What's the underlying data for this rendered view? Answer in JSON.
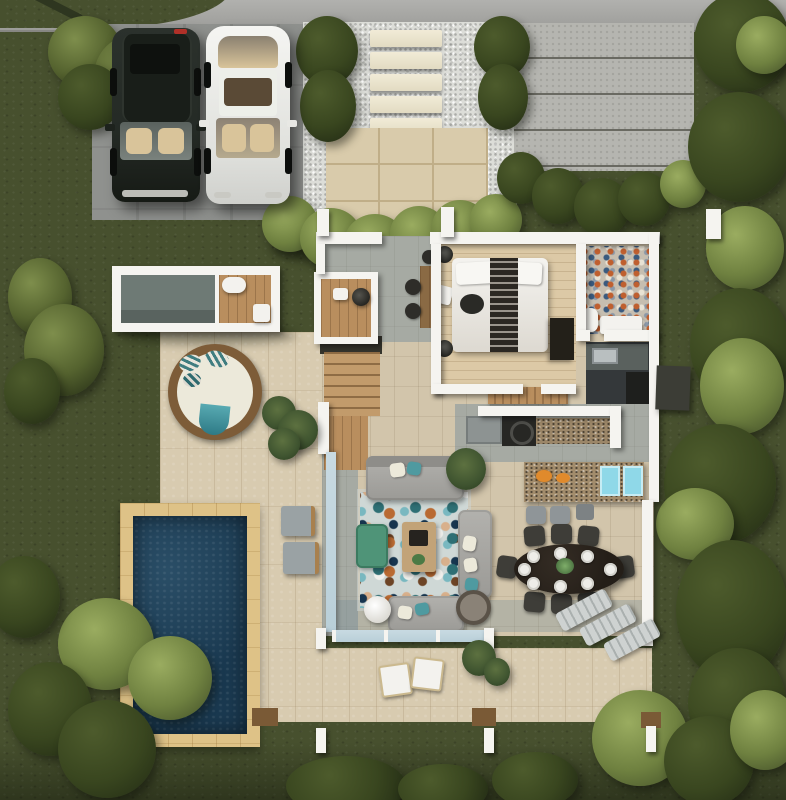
{
  "title": "villa-site-plan-render",
  "palette": {
    "grass": "#47502e",
    "grass_dark": "#323a1d",
    "bush_light": "#7e8e4c",
    "bush": "#55632f",
    "bush_dark": "#2b3419",
    "road": "#a7a7a3",
    "driveway": "#8f918e",
    "gravel": "#dcddd8",
    "stone": "#ece6d0",
    "patio": "#d9cbab",
    "patio_grout": "#c0ae88",
    "pad": "#b5b5b0",
    "pad_line": "#6a6a62",
    "wall": "#f5f4f0",
    "floor": "#d2c5ab",
    "terrace": "#d8cbb0",
    "wood_deck": "#b98e5e",
    "pool": "#1a3950",
    "pool_deck": "#dec287",
    "sofa": "#a6a5a1",
    "teal": "#4f9aa0",
    "ottoman": "#4f9478",
    "glass": "#b9cfd8",
    "suv": "#242a25",
    "car_white": "#f1f1ed",
    "interior_tan": "#d9c49a",
    "counter_dark": "#2c2c2a",
    "granite": "#9b8668",
    "island": "#a28c6c",
    "mat": "#8fd8e8",
    "flower": "#e08a2c",
    "table": "#241e18",
    "chair": "#3e3d38",
    "cushion": "#ece9da",
    "lounger": "#c6cac9",
    "outbuilding": "#6e7a75",
    "daybed": "#7d5c38",
    "mosaic": "#c6beb0"
  },
  "scene": {
    "site": [
      "lawn",
      "street-strip",
      "driveway",
      "gravel-path",
      "stepping-stones",
      "entry-patio",
      "concrete-pad",
      "hedges",
      "garden-bushes",
      "perimeter-trees"
    ],
    "vehicles": [
      "black-suv",
      "white-sedan"
    ],
    "house_rooms": [
      "entry",
      "study-nook",
      "bedroom",
      "bathroom",
      "kitchen",
      "hallway",
      "stairs",
      "living-room",
      "dining-area"
    ],
    "furniture": [
      "bed",
      "nightstands",
      "wardrobe",
      "desk",
      "console-table",
      "stools",
      "sofa-sectional",
      "coffee-table",
      "ottoman",
      "pouf",
      "hexagon-rug",
      "kitchen-island",
      "bar-stools",
      "dining-table",
      "dining-chairs",
      "plates"
    ],
    "outdoor": [
      "outbuilding",
      "round-daybed",
      "terrace",
      "pool",
      "pool-deck",
      "poolside-chairs",
      "sun-loungers",
      "patio-chairs",
      "palms",
      "pergola-posts",
      "ac-unit",
      "glass-walls"
    ]
  },
  "counts": {
    "cars": 2,
    "stepping_stones": 5,
    "concrete_pad_slabs": 5,
    "dining_chairs": 8,
    "plates": 8,
    "bar_stools": 2,
    "sun_loungers": 3,
    "poolside_chairs": 2,
    "patio_chairs": 2
  }
}
